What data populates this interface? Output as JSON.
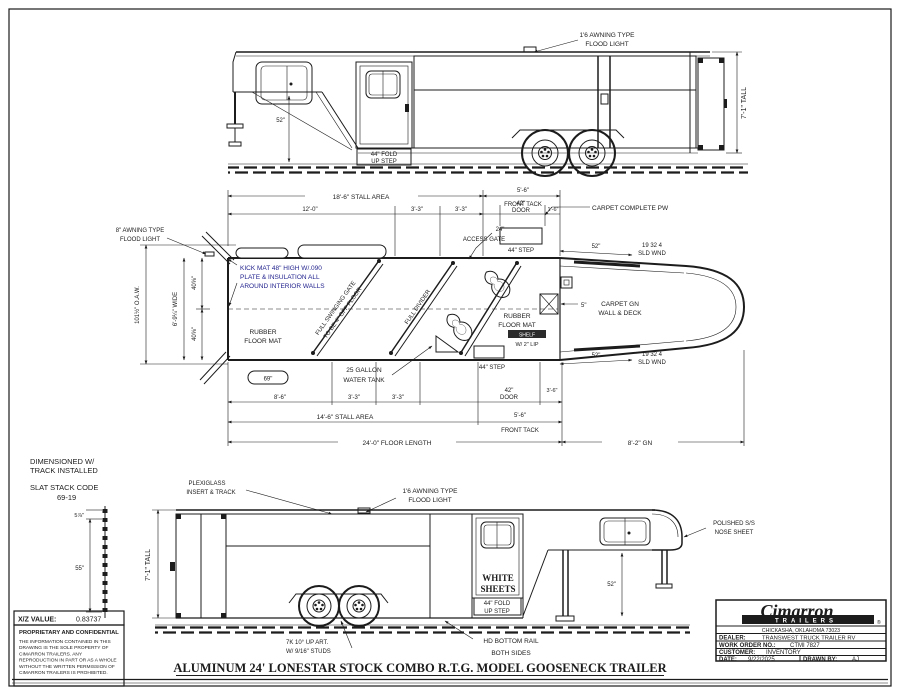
{
  "colors": {
    "line": "#1c1c1c",
    "note_blue": "#1e1e8c",
    "paper": "#ffffff"
  },
  "title": {
    "main": "ALUMINUM 24' LONESTAR STOCK COMBO R.T.G. MODEL GOOSENECK TRAILER"
  },
  "top": {
    "flood1": "1'6 AWNING TYPE",
    "flood2": "FLOOD LIGHT",
    "fold1": "44\" FOLD",
    "fold2": "UP STEP",
    "tall": "7'-1\" TALL",
    "dim52": "52\""
  },
  "plan": {
    "stall_top": "18'-6\" STALL AREA",
    "ft_t1": "5'-6\"",
    "ft_t2": "FRONT TACK",
    "d12": "12'-0\"",
    "d33a": "3'-3\"",
    "d33b": "3'-3\"",
    "door42t1": "42\"",
    "door42t2": "DOOR",
    "d16": "1'-6\"",
    "access1": "24\"",
    "access2": "ACCESS GATE",
    "carpet_pw": "CARPET COMPLETE PW",
    "awn1": "8\" AWNING TYPE",
    "awn2": "FLOOD LIGHT",
    "kick1": "KICK MAT 48\" HIGH W/.090",
    "kick2": "PLATE & INSULATION ALL",
    "kick3": "AROUND INTERIOR WALLS",
    "oaw": "101½\" O.A.W.",
    "wide": "6'-9¼\" WIDE",
    "w40a": "40⅝\"",
    "w40b": "40⅝\"",
    "gate1a": "FULL SWINGING GATE",
    "gate1b": "TO BE 4\" OFF FLOOR",
    "divider": "FULL DIVIDER",
    "rub_r1": "RUBBER",
    "rub_r2": "FLOOR MAT",
    "rub_l1": "RUBBER",
    "rub_l2": "FLOOR MAT",
    "tank1": "25 GALLON",
    "tank2": "WATER TANK",
    "d69": "69\"",
    "step_t": "44\" STEP",
    "step_b": "44\" STEP",
    "shelf1": "SHELF",
    "shelf2": "W/ 2\" LIP",
    "d5": "5\"",
    "cgn1": "CARPET GN",
    "cgn2": "WALL & DECK",
    "wndt1": "19 32 4",
    "wndt2": "SLD WND",
    "wndt_d": "52\"",
    "wndb1": "19 32 4",
    "wndb2": "SLD WND",
    "wndb_d": "52\"",
    "d86": "8'-6\"",
    "d33c": "3'-3\"",
    "d33d": "3'-3\"",
    "door42b1": "42\"",
    "door42b2": "DOOR",
    "d36": "3'-6\"",
    "stall_bot": "14'-6\" STALL AREA",
    "ft_b1": "5'-6\"",
    "ft_b2": "FRONT TACK",
    "floor_len": "24'-0\" FLOOR LENGTH",
    "gn_len": "8'-2\" GN"
  },
  "bottom": {
    "plexi1": "PLEXIGLASS",
    "plexi2": "INSERT & TRACK",
    "flood1": "1'6 AWNING TYPE",
    "flood2": "FLOOD LIGHT",
    "tall": "7'-1\" TALL",
    "white1": "WHITE",
    "white2": "SHEETS",
    "fold1": "44\" FOLD",
    "fold2": "UP STEP",
    "axle1": "7K 10° UP ART.",
    "axle2": "W/ 9/16\" STUDS",
    "rail1": "HD BOTTOM RAIL",
    "rail2": "BOTH SIDES",
    "nose1": "POLISHED S/S",
    "nose2": "NOSE SHEET",
    "dim52": "52\""
  },
  "notes": {
    "dim1": "DIMENSIONED W/",
    "dim2": "TRACK INSTALLED",
    "code1": "SLAT STACK CODE",
    "code2": "69-19",
    "slat_top": "5⅞\"",
    "slat_h": "55\"",
    "xz_label": "X/Z VALUE:",
    "xz_value": "0.83737",
    "prop_title": "PROPRIETARY AND CONFIDENTIAL",
    "b1": "THE INFORMATION CONTAINED IN THIS",
    "b2": "DRAWING IS THE SOLE PROPERTY OF",
    "b3": "CIMARRON TRAILERS.  ANY",
    "b4": "REPRODUCTION IN PART OR AS A WHOLE",
    "b5": "WITHOUT THE WRITTEN PERMISSION OF",
    "b6": "CIMARRON TRAILERS IS PROHIBITED."
  },
  "tb": {
    "brand": "Cimarron",
    "band": "TRAILERS",
    "reg": "®",
    "city": "CHICKASHA, OKLAHOMA 73023",
    "dealer_l": "DEALER:",
    "dealer_v": "TRANSWEST TRUCK TRAILER RV",
    "wo_l": "WORK ORDER NO.:",
    "wo_v": "CTMI 7827",
    "cust_l": "CUSTOMER:",
    "cust_v": "INVENTORY",
    "date_l": "DATE:",
    "date_v": "9/22/2025",
    "drawn_l": "DRAWN BY:",
    "drawn_v": "AJ"
  }
}
